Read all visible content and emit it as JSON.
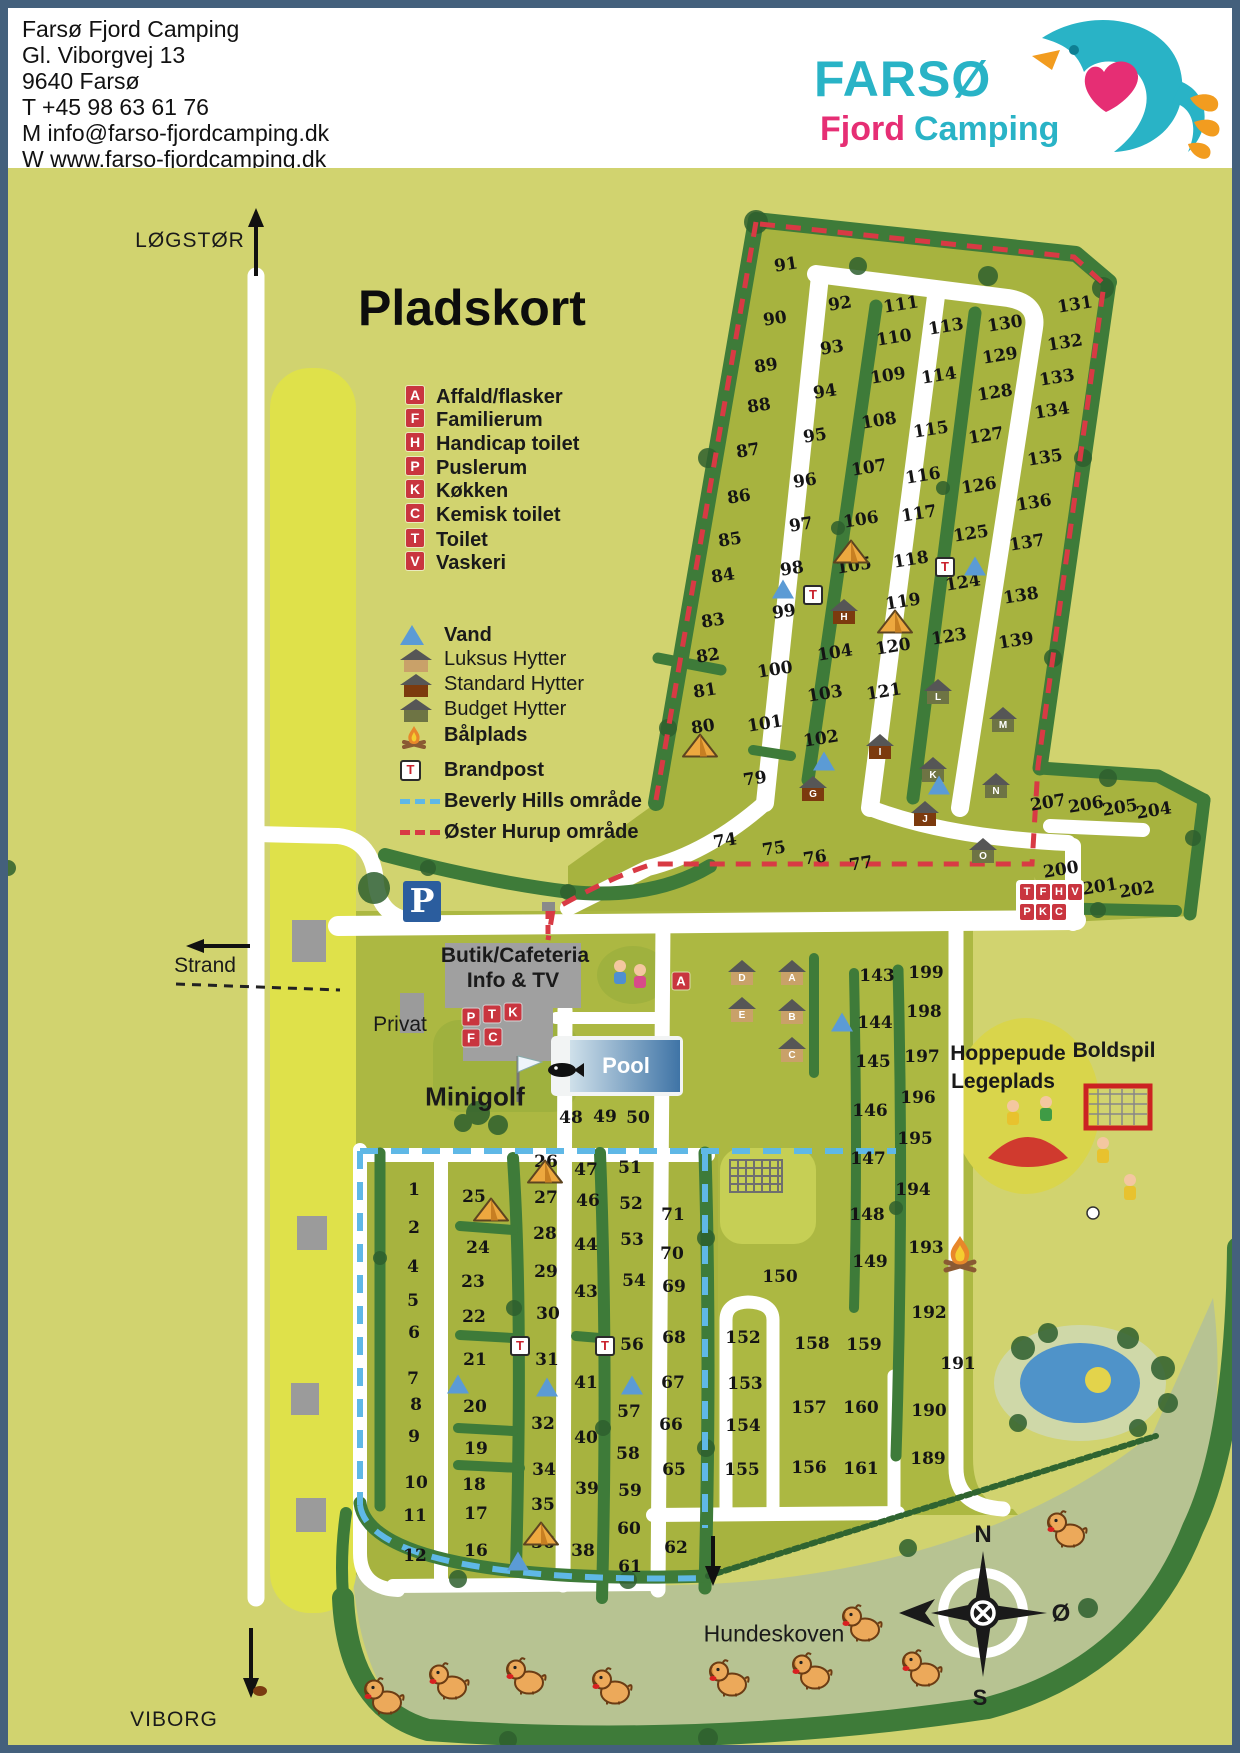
{
  "header": {
    "lines": [
      "Farsø Fjord Camping",
      "Gl. Viborgvej 13",
      "9640 Farsø",
      "T +45 98 63 61 76",
      "M info@farso-fjordcamping.dk",
      "W www.farso-fjordcamping.dk"
    ]
  },
  "logo": {
    "word1": "FARSØ",
    "word2": "Fjord",
    "word3": "Camping"
  },
  "map": {
    "title": "Pladskort",
    "labels": [
      {
        "name": "title",
        "text": "Pladskort",
        "x": 350,
        "y": 300
      },
      {
        "name": "logstor",
        "text": "LØGSTØR",
        "x": 182,
        "y": 233
      },
      {
        "name": "viborg",
        "text": "VIBORG",
        "x": 166,
        "y": 1712
      },
      {
        "name": "strand",
        "text": "Strand",
        "x": 197,
        "y": 958
      },
      {
        "name": "privat",
        "text": "Privat",
        "x": 392,
        "y": 1017
      },
      {
        "name": "minigolf",
        "text": "Minigolf",
        "x": 467,
        "y": 1089
      },
      {
        "name": "pool",
        "text": "Pool",
        "x": 618,
        "y": 1058
      },
      {
        "name": "butik1",
        "text": "Butik/Cafeteria",
        "x": 507,
        "y": 948
      },
      {
        "name": "butik2",
        "text": "Info & TV",
        "x": 505,
        "y": 973
      },
      {
        "name": "hoppepude1",
        "text": "Hoppepude",
        "x": 1000,
        "y": 1046
      },
      {
        "name": "hoppepude2",
        "text": "Legeplads",
        "x": 995,
        "y": 1074
      },
      {
        "name": "boldspil",
        "text": "Boldspil",
        "x": 1106,
        "y": 1043
      },
      {
        "name": "hundeskoven",
        "text": "Hundeskoven",
        "x": 766,
        "y": 1626
      }
    ],
    "compass": {
      "n": "N",
      "east": "Ø",
      "s": "S"
    },
    "legend": {
      "services": [
        {
          "letter": "A",
          "label": "Affald/flasker"
        },
        {
          "letter": "F",
          "label": "Familierum"
        },
        {
          "letter": "H",
          "label": "Handicap toilet"
        },
        {
          "letter": "P",
          "label": "Puslerum"
        },
        {
          "letter": "K",
          "label": "Køkken"
        },
        {
          "letter": "C",
          "label": "Kemisk toilet"
        },
        {
          "letter": "T",
          "label": "Toilet"
        },
        {
          "letter": "V",
          "label": "Vaskeri"
        }
      ],
      "items": [
        {
          "icon": "vand",
          "label": "Vand"
        },
        {
          "icon": "luksus",
          "label": "Luksus Hytter"
        },
        {
          "icon": "standard",
          "label": "Standard Hytter"
        },
        {
          "icon": "budget",
          "label": "Budget Hytter"
        },
        {
          "icon": "baalplads",
          "label": "Bålplads"
        },
        {
          "icon": "brandpost",
          "label": "Brandpost"
        },
        {
          "icon": "beverly",
          "label": "Beverly Hills område"
        },
        {
          "icon": "oster",
          "label": "Øster Hurup område"
        }
      ]
    },
    "plots": [
      [
        91,
        778,
        257,
        1
      ],
      [
        90,
        767,
        311,
        1
      ],
      [
        89,
        758,
        358,
        1
      ],
      [
        88,
        751,
        398,
        1
      ],
      [
        87,
        740,
        443,
        1
      ],
      [
        86,
        731,
        489,
        1
      ],
      [
        85,
        722,
        532,
        1
      ],
      [
        84,
        715,
        568,
        1
      ],
      [
        83,
        705,
        613,
        1
      ],
      [
        82,
        700,
        648,
        1
      ],
      [
        81,
        697,
        683,
        1
      ],
      [
        80,
        695,
        719,
        1
      ],
      [
        79,
        747,
        771,
        1
      ],
      [
        74,
        717,
        833,
        1
      ],
      [
        75,
        766,
        841,
        1
      ],
      [
        76,
        807,
        850,
        1
      ],
      [
        77,
        853,
        856,
        1
      ],
      [
        92,
        832,
        296,
        1
      ],
      [
        93,
        824,
        340,
        1
      ],
      [
        94,
        817,
        384,
        1
      ],
      [
        95,
        807,
        428,
        1
      ],
      [
        96,
        797,
        473,
        1
      ],
      [
        97,
        793,
        517,
        1
      ],
      [
        98,
        784,
        561,
        1
      ],
      [
        99,
        776,
        604,
        1
      ],
      [
        100,
        767,
        662,
        1
      ],
      [
        101,
        757,
        716,
        1
      ],
      [
        102,
        813,
        731,
        1
      ],
      [
        103,
        817,
        686,
        1
      ],
      [
        104,
        827,
        645,
        1
      ],
      [
        105,
        846,
        558,
        1
      ],
      [
        106,
        853,
        512,
        1
      ],
      [
        107,
        861,
        460,
        1
      ],
      [
        108,
        871,
        413,
        1
      ],
      [
        109,
        880,
        368,
        1
      ],
      [
        110,
        886,
        330,
        1
      ],
      [
        111,
        893,
        297,
        1
      ],
      [
        113,
        938,
        319,
        1
      ],
      [
        114,
        931,
        368,
        1
      ],
      [
        115,
        923,
        422,
        1
      ],
      [
        116,
        915,
        468,
        1
      ],
      [
        117,
        911,
        506,
        1
      ],
      [
        118,
        903,
        552,
        1
      ],
      [
        119,
        895,
        594,
        1
      ],
      [
        120,
        885,
        639,
        1
      ],
      [
        121,
        876,
        684,
        1
      ],
      [
        123,
        941,
        629,
        1
      ],
      [
        124,
        955,
        575,
        1
      ],
      [
        125,
        963,
        526,
        1
      ],
      [
        126,
        971,
        478,
        1
      ],
      [
        127,
        978,
        428,
        1
      ],
      [
        128,
        987,
        385,
        1
      ],
      [
        129,
        992,
        348,
        1
      ],
      [
        130,
        997,
        316,
        1
      ],
      [
        131,
        1067,
        297,
        1
      ],
      [
        132,
        1057,
        335,
        1
      ],
      [
        133,
        1049,
        370,
        1
      ],
      [
        134,
        1044,
        403,
        1
      ],
      [
        135,
        1037,
        450,
        1
      ],
      [
        136,
        1026,
        495,
        1
      ],
      [
        137,
        1019,
        535,
        1
      ],
      [
        138,
        1013,
        588,
        1
      ],
      [
        139,
        1008,
        633,
        1
      ],
      [
        200,
        1053,
        862,
        1
      ],
      [
        201,
        1092,
        879,
        1
      ],
      [
        202,
        1129,
        882,
        1
      ],
      [
        204,
        1146,
        803,
        1
      ],
      [
        205,
        1112,
        800,
        1
      ],
      [
        206,
        1078,
        797,
        1
      ],
      [
        207,
        1040,
        795,
        1
      ],
      [
        143,
        869,
        968,
        0
      ],
      [
        144,
        867,
        1015,
        0
      ],
      [
        145,
        865,
        1054,
        0
      ],
      [
        146,
        862,
        1103,
        0
      ],
      [
        147,
        860,
        1151,
        0
      ],
      [
        148,
        859,
        1207,
        0
      ],
      [
        149,
        862,
        1254,
        0
      ],
      [
        199,
        918,
        965,
        0
      ],
      [
        198,
        916,
        1004,
        0
      ],
      [
        197,
        914,
        1049,
        0
      ],
      [
        196,
        910,
        1090,
        0
      ],
      [
        195,
        907,
        1131,
        0
      ],
      [
        194,
        905,
        1182,
        0
      ],
      [
        193,
        918,
        1240,
        0
      ],
      [
        192,
        921,
        1305,
        0
      ],
      [
        191,
        950,
        1356,
        0
      ],
      [
        190,
        921,
        1403,
        0
      ],
      [
        189,
        920,
        1451,
        0
      ],
      [
        150,
        772,
        1269,
        0
      ],
      [
        152,
        735,
        1330,
        0
      ],
      [
        153,
        737,
        1376,
        0
      ],
      [
        154,
        735,
        1418,
        0
      ],
      [
        155,
        734,
        1462,
        0
      ],
      [
        156,
        801,
        1460,
        0
      ],
      [
        157,
        801,
        1400,
        0
      ],
      [
        158,
        804,
        1336,
        0
      ],
      [
        159,
        856,
        1337,
        0
      ],
      [
        160,
        853,
        1400,
        0
      ],
      [
        161,
        853,
        1461,
        0
      ],
      [
        48,
        563,
        1110,
        0
      ],
      [
        49,
        597,
        1109,
        0
      ],
      [
        50,
        630,
        1110,
        0
      ],
      [
        1,
        406,
        1182,
        0
      ],
      [
        2,
        406,
        1220,
        0
      ],
      [
        4,
        405,
        1259,
        0
      ],
      [
        5,
        405,
        1293,
        0
      ],
      [
        6,
        406,
        1325,
        0
      ],
      [
        7,
        405,
        1371,
        0
      ],
      [
        8,
        408,
        1397,
        0
      ],
      [
        9,
        406,
        1429,
        0
      ],
      [
        10,
        408,
        1475,
        0
      ],
      [
        11,
        407,
        1508,
        0
      ],
      [
        12,
        407,
        1548,
        0
      ],
      [
        25,
        466,
        1189,
        0
      ],
      [
        24,
        470,
        1240,
        0
      ],
      [
        23,
        465,
        1274,
        0
      ],
      [
        22,
        466,
        1309,
        0
      ],
      [
        21,
        467,
        1352,
        0
      ],
      [
        20,
        467,
        1399,
        0
      ],
      [
        19,
        468,
        1441,
        0
      ],
      [
        18,
        466,
        1477,
        0
      ],
      [
        17,
        468,
        1506,
        0
      ],
      [
        16,
        468,
        1543,
        0
      ],
      [
        26,
        538,
        1154,
        0
      ],
      [
        27,
        538,
        1190,
        0
      ],
      [
        28,
        537,
        1226,
        0
      ],
      [
        29,
        538,
        1264,
        0
      ],
      [
        30,
        540,
        1306,
        0
      ],
      [
        31,
        539,
        1352,
        0
      ],
      [
        32,
        535,
        1416,
        0
      ],
      [
        34,
        536,
        1462,
        0
      ],
      [
        35,
        535,
        1497,
        0
      ],
      [
        36,
        535,
        1535,
        0
      ],
      [
        47,
        578,
        1162,
        0
      ],
      [
        46,
        580,
        1193,
        0
      ],
      [
        44,
        578,
        1237,
        0
      ],
      [
        43,
        578,
        1284,
        0
      ],
      [
        41,
        578,
        1375,
        0
      ],
      [
        40,
        578,
        1430,
        0
      ],
      [
        39,
        579,
        1481,
        0
      ],
      [
        38,
        575,
        1543,
        0
      ],
      [
        51,
        622,
        1160,
        0
      ],
      [
        52,
        623,
        1196,
        0
      ],
      [
        53,
        624,
        1232,
        0
      ],
      [
        54,
        626,
        1273,
        0
      ],
      [
        56,
        624,
        1337,
        0
      ],
      [
        57,
        621,
        1404,
        0
      ],
      [
        58,
        620,
        1446,
        0
      ],
      [
        59,
        622,
        1483,
        0
      ],
      [
        60,
        621,
        1521,
        0
      ],
      [
        61,
        622,
        1559,
        0
      ],
      [
        71,
        665,
        1207,
        0
      ],
      [
        70,
        664,
        1246,
        0
      ],
      [
        69,
        666,
        1279,
        0
      ],
      [
        68,
        666,
        1330,
        0
      ],
      [
        67,
        665,
        1375,
        0
      ],
      [
        66,
        663,
        1417,
        0
      ],
      [
        65,
        666,
        1462,
        0
      ],
      [
        62,
        668,
        1540,
        0
      ]
    ],
    "cabins": [
      {
        "l": "D",
        "t": "lux",
        "x": 734,
        "y": 965
      },
      {
        "l": "A",
        "t": "lux",
        "x": 784,
        "y": 965
      },
      {
        "l": "E",
        "t": "lux",
        "x": 734,
        "y": 1002
      },
      {
        "l": "B",
        "t": "lux",
        "x": 784,
        "y": 1004
      },
      {
        "l": "C",
        "t": "lux",
        "x": 784,
        "y": 1042
      },
      {
        "l": "H",
        "t": "std",
        "x": 836,
        "y": 604
      },
      {
        "l": "G",
        "t": "std",
        "x": 805,
        "y": 781
      },
      {
        "l": "I",
        "t": "std",
        "x": 872,
        "y": 739
      },
      {
        "l": "J",
        "t": "std",
        "x": 917,
        "y": 806
      },
      {
        "l": "K",
        "t": "bud",
        "x": 925,
        "y": 762
      },
      {
        "l": "L",
        "t": "bud",
        "x": 930,
        "y": 684
      },
      {
        "l": "M",
        "t": "bud",
        "x": 995,
        "y": 712
      },
      {
        "l": "N",
        "t": "bud",
        "x": 988,
        "y": 778
      },
      {
        "l": "O",
        "t": "bud",
        "x": 975,
        "y": 843
      }
    ],
    "service_boxes": [
      {
        "l": "A",
        "x": 673,
        "y": 973
      },
      {
        "l": "P",
        "x": 463,
        "y": 1009
      },
      {
        "l": "T",
        "x": 484,
        "y": 1006
      },
      {
        "l": "K",
        "x": 505,
        "y": 1004
      },
      {
        "l": "F",
        "x": 463,
        "y": 1030
      },
      {
        "l": "C",
        "x": 485,
        "y": 1029
      }
    ],
    "service_cluster": {
      "x": 1008,
      "y": 872,
      "rows": [
        [
          "T",
          "F",
          "H",
          "V"
        ],
        [
          "P",
          "K",
          "C"
        ]
      ]
    },
    "tents": [
      [
        692,
        740
      ],
      [
        843,
        546
      ],
      [
        887,
        616
      ],
      [
        483,
        1204
      ],
      [
        537,
        1166
      ],
      [
        533,
        1528
      ]
    ],
    "water_points": [
      [
        775,
        581
      ],
      [
        816,
        753
      ],
      [
        931,
        777
      ],
      [
        967,
        558
      ],
      [
        450,
        1376
      ],
      [
        539,
        1379
      ],
      [
        624,
        1377
      ],
      [
        510,
        1553
      ],
      [
        834,
        1014
      ]
    ],
    "fire_hydrants": [
      [
        805,
        587
      ],
      [
        937,
        559
      ],
      [
        512,
        1338
      ],
      [
        597,
        1338
      ]
    ],
    "campfire": [
      952,
      1252
    ],
    "dogs": [
      [
        375,
        1690
      ],
      [
        440,
        1675
      ],
      [
        517,
        1670
      ],
      [
        603,
        1680
      ],
      [
        720,
        1672
      ],
      [
        803,
        1665
      ],
      [
        913,
        1662
      ],
      [
        853,
        1617
      ],
      [
        1058,
        1523
      ]
    ],
    "parking_letter": "P",
    "pool_label": "Pool",
    "colors": {
      "frame": "#44607c",
      "pale": "#d1d36f",
      "olive": "#a7b33f",
      "beach": "#dfe14a",
      "sage": "#b7c392",
      "tree": "#3e7b39",
      "tree_dark": "#2e5f2e",
      "red_dash": "#d83a44",
      "blue_dash": "#5fb8e6",
      "service_red": "#c9353f",
      "parking_blue": "#2b5d9e",
      "pond": "#4f93c9",
      "lux": "#c9a169",
      "std": "#7c3a0e",
      "bud": "#6e7444"
    }
  }
}
